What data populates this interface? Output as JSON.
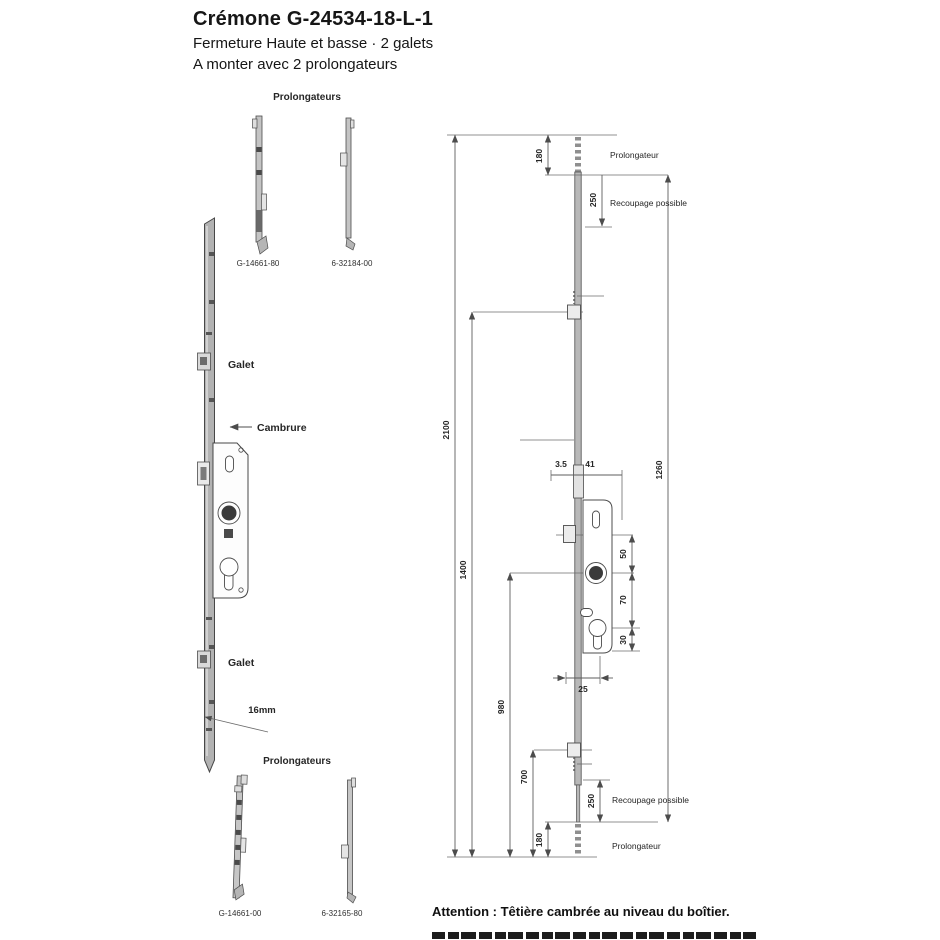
{
  "colors": {
    "ink": "#4c4c4c",
    "metal_fill": "#b8b8b8",
    "background": "#ffffff"
  },
  "title": {
    "line1": "Crémone G-24534-18-L-1",
    "line2": "Fermeture Haute et basse · 2 galets",
    "line3": "A monter avec 2 prolongateurs"
  },
  "left_panel": {
    "top_group_label": "Prolongateurs",
    "top_part_numbers": [
      "G-14661-80",
      "6-32184-00"
    ],
    "galet_top_label": "Galet",
    "cambrure_label": "Cambrure",
    "galet_bottom_label": "Galet",
    "rail_width_label": "16mm",
    "bottom_group_label": "Prolongateurs",
    "bottom_part_numbers": [
      "G-14661-00",
      "6-32165-80"
    ]
  },
  "drawing": {
    "dims": {
      "total_length": "2100",
      "galets_span": "1400",
      "handle_to_end": "980",
      "galet_bottom_to_end": "700",
      "body_span": "1260",
      "prolongateur_overlap_top": "180",
      "recoupage_top": "250",
      "face_offset": "3.5",
      "backset": "41",
      "galet_to_handle": "50",
      "handle_to_cylinder": "70",
      "cylinder_to_case_end": "30",
      "case_width": "25",
      "recoupage_bottom": "250",
      "prolongateur_overlap_bottom": "180"
    },
    "labels": {
      "prolongateur_top": "Prolongateur",
      "recoupage_top": "Recoupage possible",
      "recoupage_bottom": "Recoupage possible",
      "prolongateur_bottom": "Prolongateur"
    }
  },
  "footer": {
    "attention": "Attention : Têtière cambrée au niveau du boîtier."
  }
}
